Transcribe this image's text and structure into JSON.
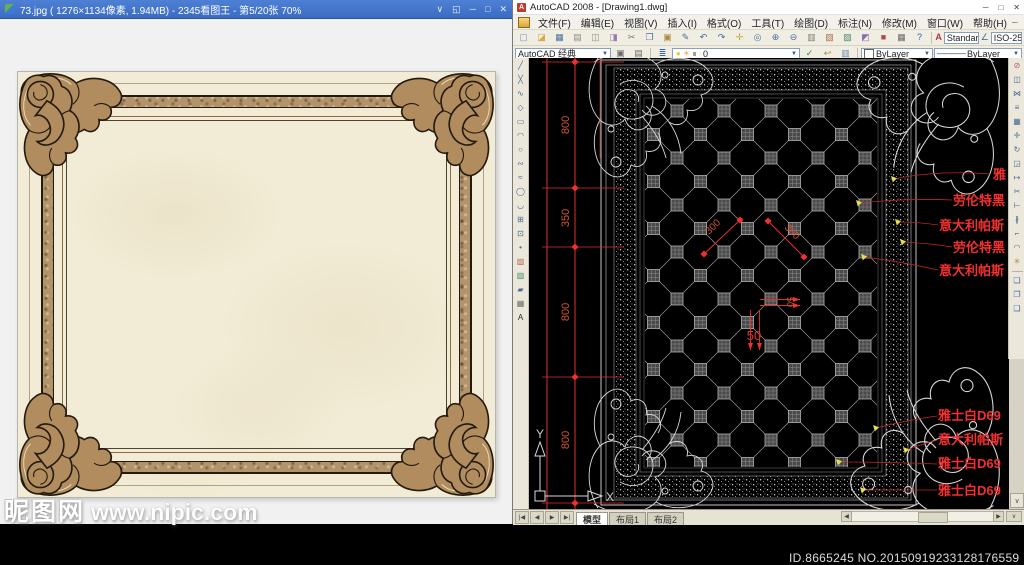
{
  "viewer": {
    "title": "73.jpg ( 1276×1134像素, 1.94MB) - 2345看图王 - 第5/20张 70%",
    "controls": [
      {
        "n": "viewer-menu-arrow-icon",
        "g": "∨"
      },
      {
        "n": "viewer-fullscreen-icon",
        "g": "◱"
      },
      {
        "n": "viewer-minimize-icon",
        "g": "─"
      },
      {
        "n": "viewer-maximize-icon",
        "g": "□"
      },
      {
        "n": "viewer-close-icon",
        "g": "✕"
      }
    ],
    "watermark": {
      "logo": "昵图网",
      "url": "www.nipic.com"
    }
  },
  "acad": {
    "title": "AutoCAD 2008 - [Drawing1.dwg]",
    "title_controls": [
      {
        "n": "acad-minimize-icon",
        "g": "─"
      },
      {
        "n": "acad-maximize-icon",
        "g": "□"
      },
      {
        "n": "acad-close-icon",
        "g": "✕"
      }
    ],
    "menu": {
      "items": [
        "文件(F)",
        "编辑(E)",
        "视图(V)",
        "插入(I)",
        "格式(O)",
        "工具(T)",
        "绘图(D)",
        "标注(N)",
        "修改(M)",
        "窗口(W)",
        "帮助(H)"
      ],
      "mdi": [
        {
          "n": "mdi-minimize-icon",
          "g": "─"
        },
        {
          "n": "mdi-restore-icon",
          "g": "❐"
        },
        {
          "n": "mdi-close-icon",
          "g": "✕"
        }
      ]
    },
    "toolbar1": {
      "icons": [
        {
          "n": "new-file-icon",
          "g": "▢",
          "c": "#7a93b8"
        },
        {
          "n": "open-folder-icon",
          "g": "◪",
          "c": "#d9a64a"
        },
        {
          "n": "save-icon",
          "g": "▦",
          "c": "#4a6fa5"
        },
        {
          "n": "plot-icon",
          "g": "▤",
          "c": "#8a8a8a"
        },
        {
          "n": "plot-preview-icon",
          "g": "◫",
          "c": "#8a8a8a"
        },
        {
          "n": "publish-icon",
          "g": "◨",
          "c": "#9a7ab0"
        },
        {
          "n": "cut-icon",
          "g": "✂",
          "c": "#777777"
        },
        {
          "n": "copy-icon",
          "g": "❐",
          "c": "#4a6fa5"
        },
        {
          "n": "paste-icon",
          "g": "▣",
          "c": "#b0893a"
        },
        {
          "n": "match-properties-icon",
          "g": "✎",
          "c": "#4a6fa5"
        },
        {
          "n": "undo-icon",
          "g": "↶",
          "c": "#3a66b0"
        },
        {
          "n": "redo-icon",
          "g": "↷",
          "c": "#3a66b0"
        },
        {
          "n": "pan-icon",
          "g": "✛",
          "c": "#caa23c"
        },
        {
          "n": "zoom-realtime-icon",
          "g": "◎",
          "c": "#4a6fa5"
        },
        {
          "n": "zoom-window-icon",
          "g": "⊕",
          "c": "#4a6fa5"
        },
        {
          "n": "zoom-previous-icon",
          "g": "⊖",
          "c": "#4a6fa5"
        },
        {
          "n": "properties-icon",
          "g": "▥",
          "c": "#7a7a7a"
        },
        {
          "n": "designcenter-icon",
          "g": "▨",
          "c": "#b06a4a"
        },
        {
          "n": "tool-palettes-icon",
          "g": "▧",
          "c": "#4a8a6a"
        },
        {
          "n": "sheetset-manager-icon",
          "g": "◩",
          "c": "#8a6ab0"
        },
        {
          "n": "markup-icon",
          "g": "■",
          "c": "#b04a4a"
        },
        {
          "n": "quickcalc-icon",
          "g": "▦",
          "c": "#6a6a6a"
        },
        {
          "n": "help-icon",
          "g": "?",
          "c": "#2a62c0"
        }
      ],
      "text_style_icon": "A",
      "standard_style": "Standard",
      "dim_style_icon": "∠",
      "dim_style": "ISO-25"
    },
    "toolbar2": {
      "workspace": "AutoCAD 经典",
      "icons_a": [
        {
          "n": "workspace-settings-icon",
          "g": "▣",
          "c": "#6a6a6a"
        },
        {
          "n": "save-workspace-icon",
          "g": "▤",
          "c": "#6a6a6a"
        }
      ],
      "layer_manager_icon": {
        "n": "layer-properties-icon",
        "g": "≣",
        "c": "#3a66b0"
      },
      "layer_icons": [
        {
          "n": "layer-on-bulb-icon",
          "g": "●",
          "c": "#e8cc3a"
        },
        {
          "n": "layer-freeze-sun-icon",
          "g": "☀",
          "c": "#e8a43c"
        },
        {
          "n": "layer-lock-icon",
          "g": "∎",
          "c": "#9a9a9a"
        },
        {
          "n": "layer-color-chip-icon",
          "g": "▪",
          "c": "#eeeeee"
        }
      ],
      "layer_name": "0",
      "icons_b": [
        {
          "n": "make-object-layer-current-icon",
          "g": "✓",
          "c": "#3a8a3a"
        },
        {
          "n": "layer-previous-icon",
          "g": "↩",
          "c": "#b08a3a"
        },
        {
          "n": "layer-states-icon",
          "g": "▥",
          "c": "#6a8ab0"
        }
      ],
      "color_value": "ByLayer",
      "lineweight_glyph": "————",
      "lineweight_value": "ByLayer"
    },
    "draw_toolbar": [
      {
        "n": "line-icon",
        "g": "╱"
      },
      {
        "n": "construction-line-icon",
        "g": "╳"
      },
      {
        "n": "polyline-icon",
        "g": "∿"
      },
      {
        "n": "polygon-icon",
        "g": "◇"
      },
      {
        "n": "rectangle-icon",
        "g": "▭"
      },
      {
        "n": "arc-icon",
        "g": "◠"
      },
      {
        "n": "circle-icon",
        "g": "○"
      },
      {
        "n": "revision-cloud-icon",
        "g": "∾"
      },
      {
        "n": "spline-icon",
        "g": "≈"
      },
      {
        "n": "ellipse-icon",
        "g": "◯"
      },
      {
        "n": "ellipse-arc-icon",
        "g": "◡"
      },
      {
        "n": "insert-block-icon",
        "g": "⊞"
      },
      {
        "n": "make-block-icon",
        "g": "⊡"
      },
      {
        "n": "point-icon",
        "g": "•"
      },
      {
        "n": "hatch-icon",
        "g": "▨",
        "c": "#b06a4a"
      },
      {
        "n": "gradient-icon",
        "g": "▧",
        "c": "#4a8a6a"
      },
      {
        "n": "region-icon",
        "g": "▰"
      },
      {
        "n": "table-icon",
        "g": "▦",
        "c": "#6a6a6a"
      },
      {
        "n": "multiline-text-icon",
        "g": "A",
        "c": "#2a2a2a"
      }
    ],
    "modify_toolbar": [
      {
        "n": "erase-icon",
        "g": "⊘",
        "c": "#b05a7a"
      },
      {
        "n": "copy-object-icon",
        "g": "◫"
      },
      {
        "n": "mirror-icon",
        "g": "⋈"
      },
      {
        "n": "offset-icon",
        "g": "≡"
      },
      {
        "n": "array-icon",
        "g": "▦"
      },
      {
        "n": "move-icon",
        "g": "✛"
      },
      {
        "n": "rotate-icon",
        "g": "↻"
      },
      {
        "n": "scale-icon",
        "g": "◲"
      },
      {
        "n": "stretch-icon",
        "g": "↦"
      },
      {
        "n": "trim-icon",
        "g": "✂"
      },
      {
        "n": "extend-icon",
        "g": "⊢"
      },
      {
        "n": "break-icon",
        "g": "∦"
      },
      {
        "n": "chamfer-icon",
        "g": "⌐"
      },
      {
        "n": "fillet-icon",
        "g": "◠"
      },
      {
        "n": "explode-icon",
        "g": "✳",
        "c": "#b08a3a"
      }
    ],
    "modify_toolbar_extra": [
      {
        "n": "group-icon",
        "g": "❏",
        "c": "#3a66b0"
      },
      {
        "n": "ungroup-icon",
        "g": "❐",
        "c": "#3a66b0"
      },
      {
        "n": "order-icon",
        "g": "❑",
        "c": "#3a66b0"
      }
    ],
    "drawing": {
      "dims_left": [
        "800",
        "350",
        "800",
        "800"
      ],
      "dims_diag": [
        "300",
        "300"
      ],
      "dims_small": [
        "50",
        "50"
      ],
      "labels_top": [
        "雅",
        "劳伦特黑",
        "意大利帕斯",
        "劳伦特黑",
        "意大利帕斯"
      ],
      "labels_bottom": [
        "雅士白D69",
        "意大利帕斯",
        "雅士白D69",
        "雅士白D69"
      ],
      "ucs": {
        "x": "X",
        "y": "Y"
      }
    },
    "tabs": {
      "nav": [
        {
          "n": "tab-first-icon",
          "g": "|◀"
        },
        {
          "n": "tab-prev-icon",
          "g": "◀"
        },
        {
          "n": "tab-next-icon",
          "g": "▶"
        },
        {
          "n": "tab-last-icon",
          "g": "▶|"
        }
      ],
      "model": "模型",
      "layout1": "布局1",
      "layout2": "布局2"
    },
    "scroll": {
      "left": "◀",
      "right": "▶",
      "down": "∨"
    },
    "watermark_id": "ID.8665245 NO.20150919233128176559",
    "colors": {
      "dim_red": "#e03030",
      "dim_text": "#cf5535",
      "label_red": "#f23030",
      "leader_red": "#c02525",
      "marker_yellow": "#e6e04e",
      "grid_gray": "#9a9a9a",
      "ornament_white": "#d8d8d8",
      "canvas_black": "#000000"
    }
  }
}
